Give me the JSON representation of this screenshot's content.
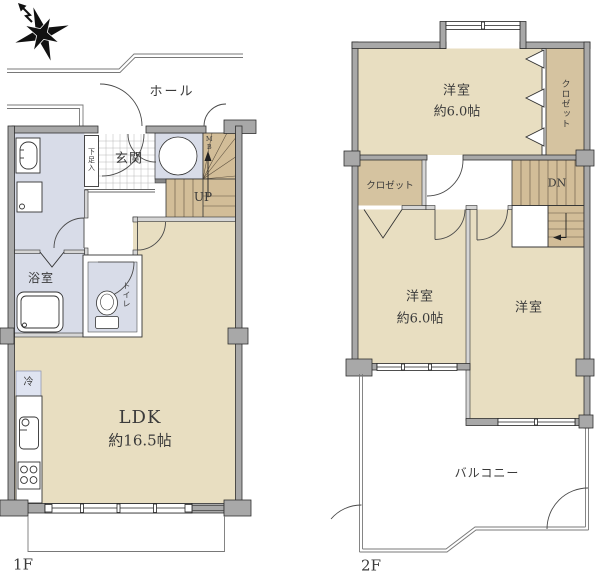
{
  "colors": {
    "background": "#ffffff",
    "wall_fill": "#a8a8a8",
    "wall_outline": "#2f2f2f",
    "inner_wall_fill": "#d6d6d6",
    "room_floor": "#e8dec1",
    "wet_room_floor": "#d8dce8",
    "stair_floor": "#d2bd98",
    "closet_floor": "#d5c3a0",
    "refrigerator_fill": "#dfe4f1",
    "fixture_line": "#333333",
    "door_line": "#4a4a4a",
    "light_line": "#787878",
    "window_line": "#222222",
    "tread_line": "#5f5240",
    "tile_line": "#b8b8b8",
    "text": "#3a3a3a"
  },
  "floor1": {
    "floor_label": "1F",
    "labels": {
      "hall": "ホール",
      "genkan": "玄関",
      "shoe_cabinet": "下足入",
      "meter_box": "MB",
      "stairs_up": "UP",
      "bathroom": "浴室",
      "toilet": "トイレ",
      "refrigerator": "冷",
      "ldk": "LDK",
      "ldk_size": "約16.5帖"
    }
  },
  "floor2": {
    "floor_label": "2F",
    "labels": {
      "bedroom_top": "洋室",
      "bedroom_top_size": "約6.0帖",
      "closet_top": "クロゼット",
      "closet_mid": "クロゼット",
      "stairs_down": "DN",
      "bedroom_left": "洋室",
      "bedroom_left_size": "約6.0帖",
      "bedroom_right": "洋室",
      "balcony": "バルコニー"
    }
  }
}
